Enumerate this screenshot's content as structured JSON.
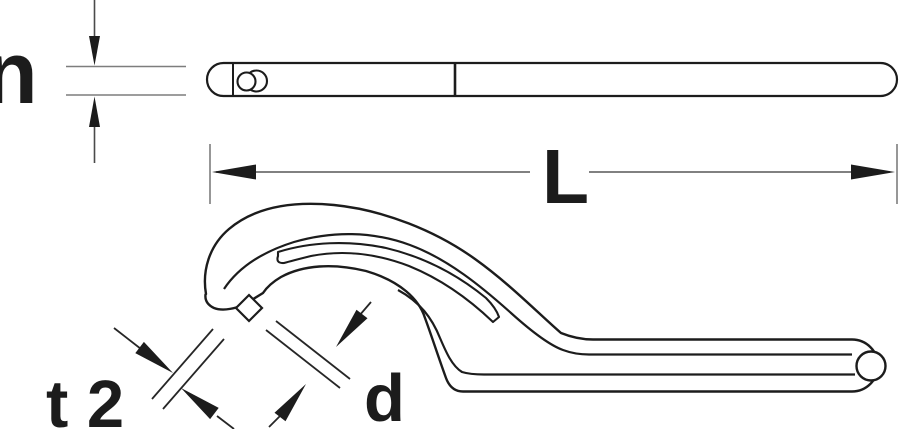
{
  "figure": {
    "type": "technical-line-drawing",
    "colors": {
      "background": "#ffffff",
      "ink": "#1c1c1c",
      "dimension_line": "#7d7d7d",
      "arrow": "#1c1c1c"
    },
    "labels": {
      "height": "n",
      "length": "L",
      "pin_thickness": "t 2",
      "pin_diameter": "d"
    }
  }
}
